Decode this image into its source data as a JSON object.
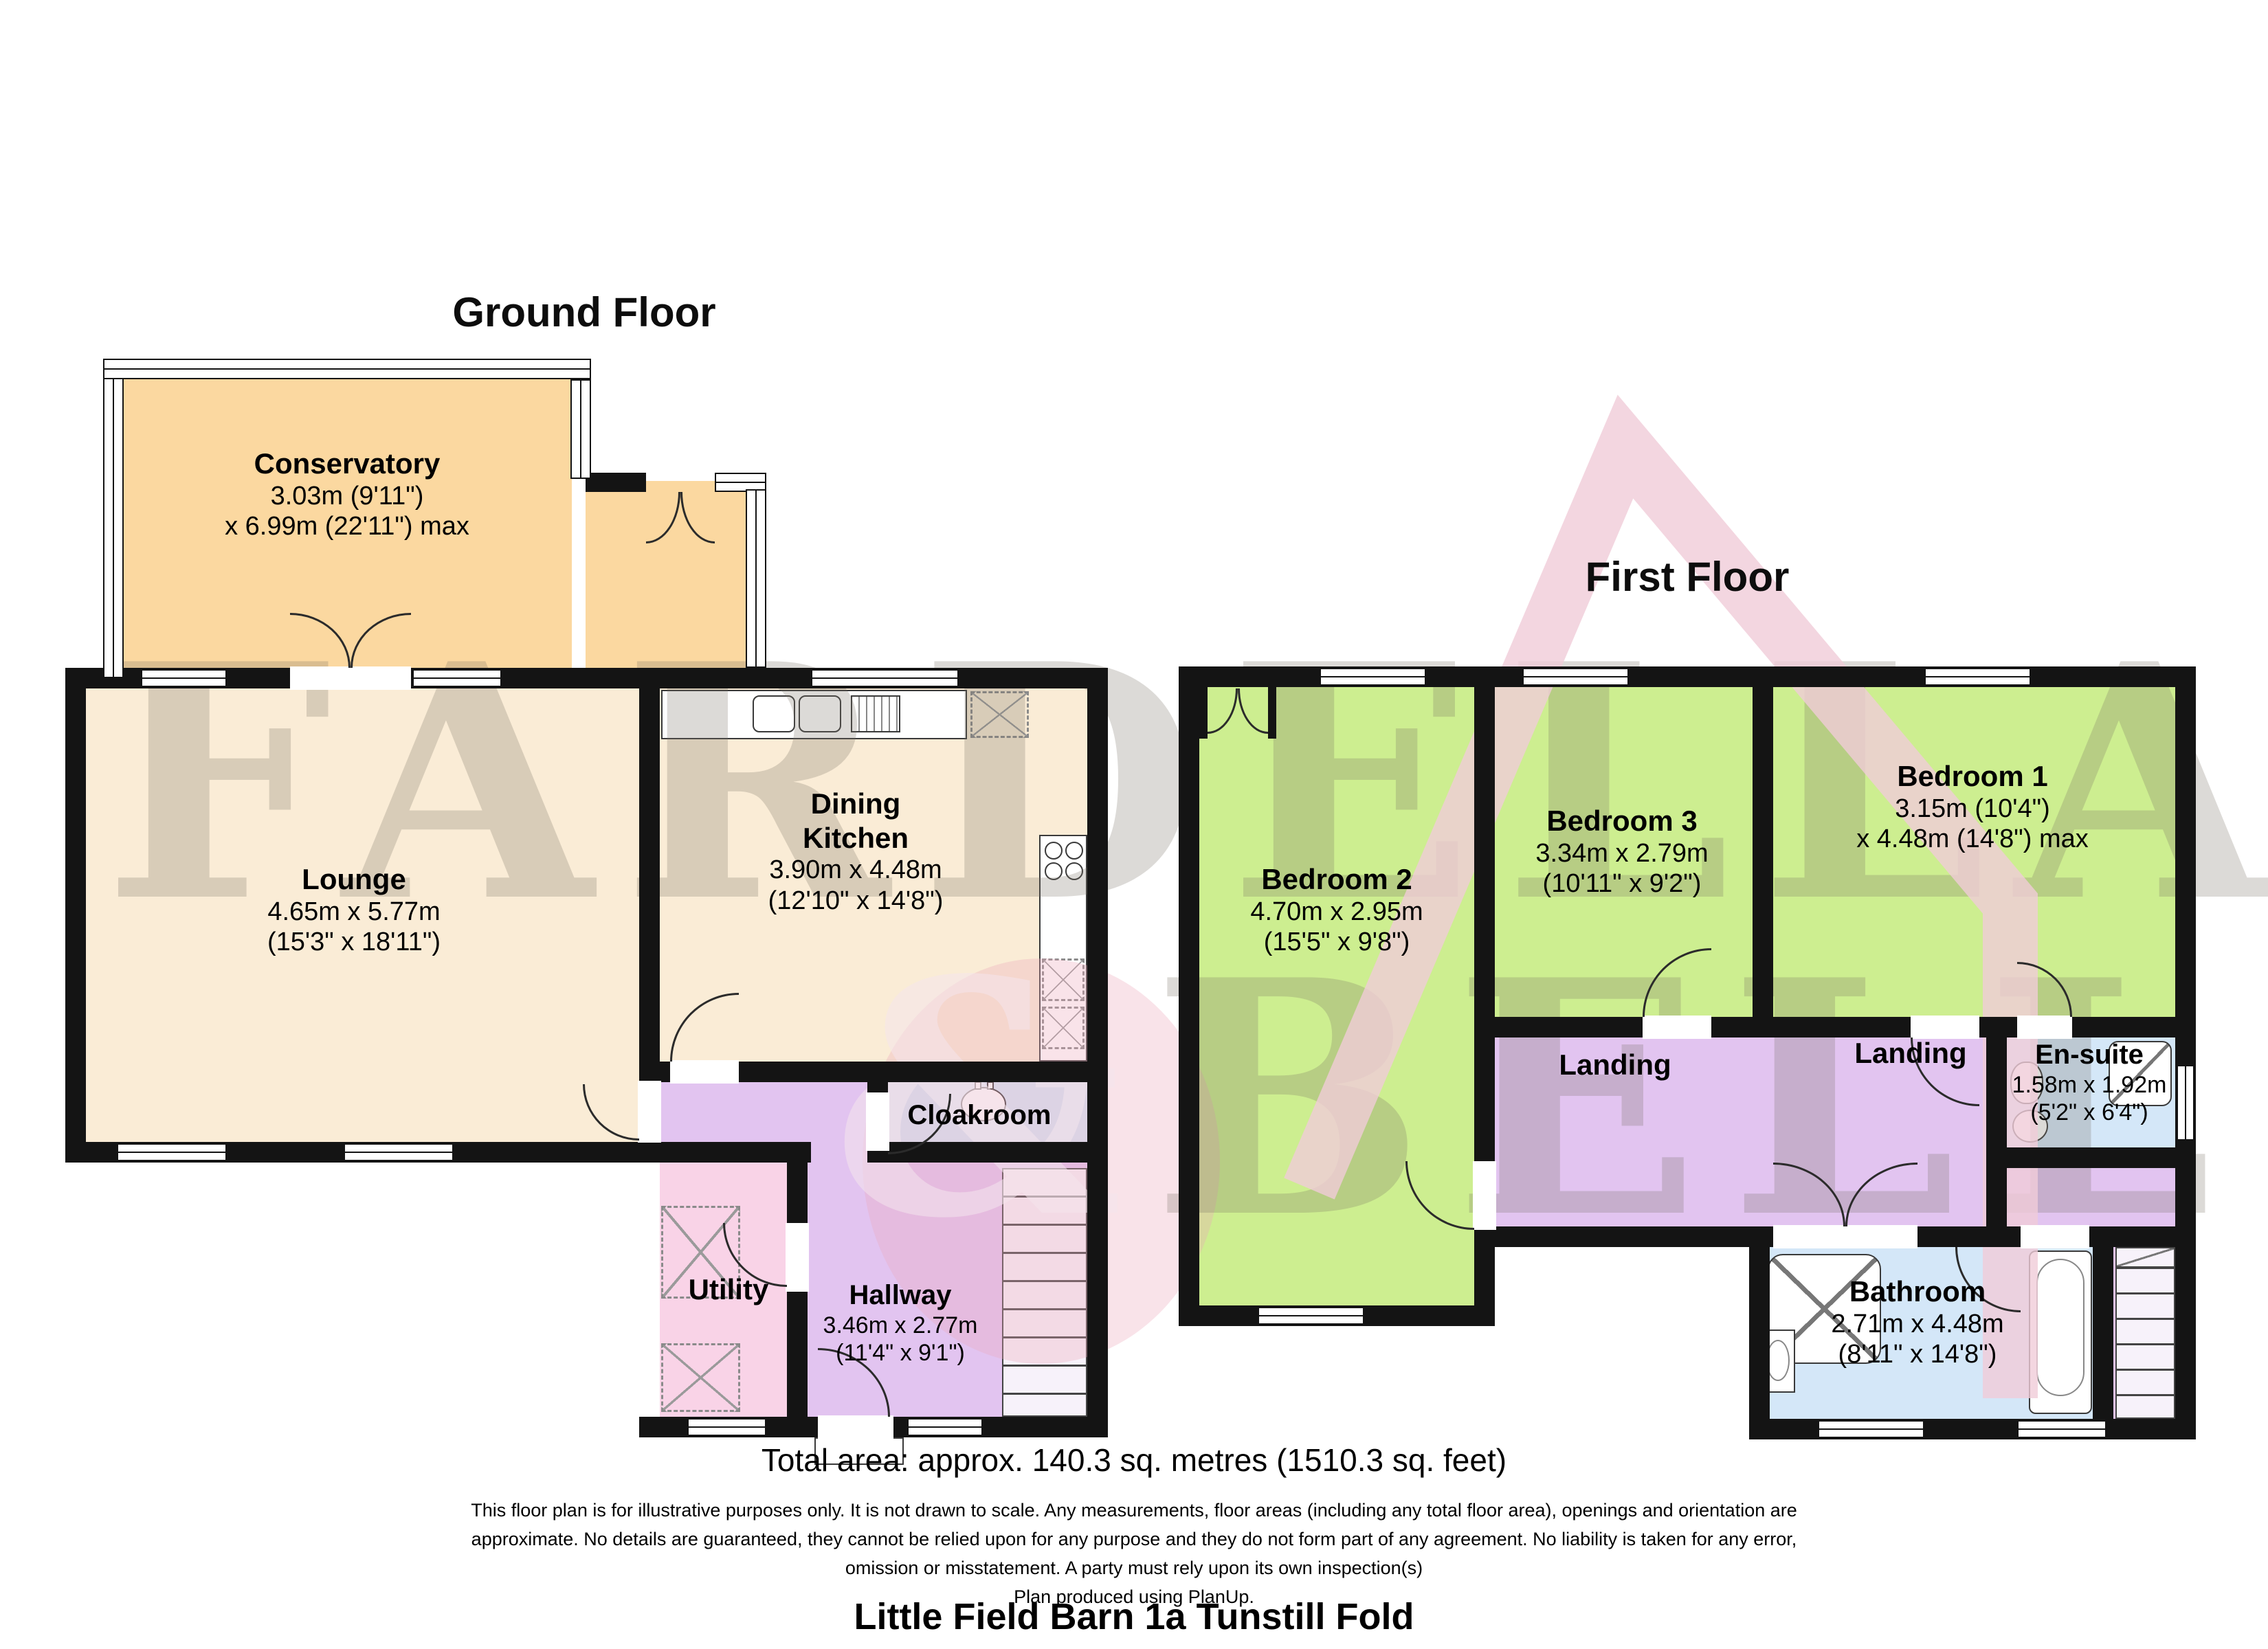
{
  "colors": {
    "conservatory_orange": "#fbd8a0",
    "room_cream": "#faecd6",
    "bedroom_green": "#cdee90",
    "landing_purple": "#e2c4f0",
    "utility_pink": "#f9d3e7",
    "bath_blue": "#d4e7f8",
    "wall_black": "#141414",
    "watermark_gray": "#767064",
    "watermark_pink": "#f0ccd8"
  },
  "gf": {
    "title": "Ground Floor",
    "conservatory": {
      "name": "Conservatory",
      "d1": "3.03m (9'11\")",
      "d2": "x 6.99m (22'11\") max"
    },
    "lounge": {
      "name": "Lounge",
      "d1": "4.65m x 5.77m",
      "d2": "(15'3\" x 18'11\")"
    },
    "kitchen": {
      "n1": "Dining",
      "n2": "Kitchen",
      "d1": "3.90m x 4.48m",
      "d2": "(12'10\" x 14'8\")"
    },
    "cloakroom": {
      "name": "Cloakroom"
    },
    "utility": {
      "name": "Utility"
    },
    "hallway": {
      "name": "Hallway",
      "d1": "3.46m x 2.77m",
      "d2": "(11'4\" x 9'1\")"
    }
  },
  "ff": {
    "title": "First Floor",
    "bedroom2": {
      "name": "Bedroom 2",
      "d1": "4.70m x 2.95m",
      "d2": "(15'5\" x 9'8\")"
    },
    "bedroom3": {
      "name": "Bedroom 3",
      "d1": "3.34m x 2.79m",
      "d2": "(10'11\" x 9'2\")"
    },
    "bedroom1": {
      "name": "Bedroom 1",
      "d1": "3.15m (10'4\")",
      "d2": "x 4.48m (14'8\") max"
    },
    "ensuite": {
      "name": "En-suite",
      "d1": "1.58m x 1.92m",
      "d2": "(5'2\" x 6'4\")"
    },
    "landing_left": {
      "name": "Landing"
    },
    "landing_right": {
      "name": "Landing"
    },
    "bathroom": {
      "name": "Bathroom",
      "d1": "2.71m x 4.48m",
      "d2": "(8'11\" x 14'8\")"
    }
  },
  "watermark": {
    "line1": "FARDELLA",
    "amp": "&",
    "line2": "BELL"
  },
  "footer": {
    "total_area": "Total area: approx. 140.3 sq. metres (1510.3 sq. feet)",
    "disclaimer1": "This floor plan is for illustrative purposes only. It is not drawn to scale. Any measurements, floor areas (including any total floor area), openings and orientation are",
    "disclaimer2": "approximate. No details are guaranteed, they cannot be relied upon for any purpose and they do not form part of any agreement. No liability is taken for any error,",
    "disclaimer3": "omission or misstatement. A party must rely upon its own inspection(s)",
    "produced": "Plan produced using PlanUp.",
    "property_title": "Little Field Barn 1a Tunstill Fold"
  }
}
